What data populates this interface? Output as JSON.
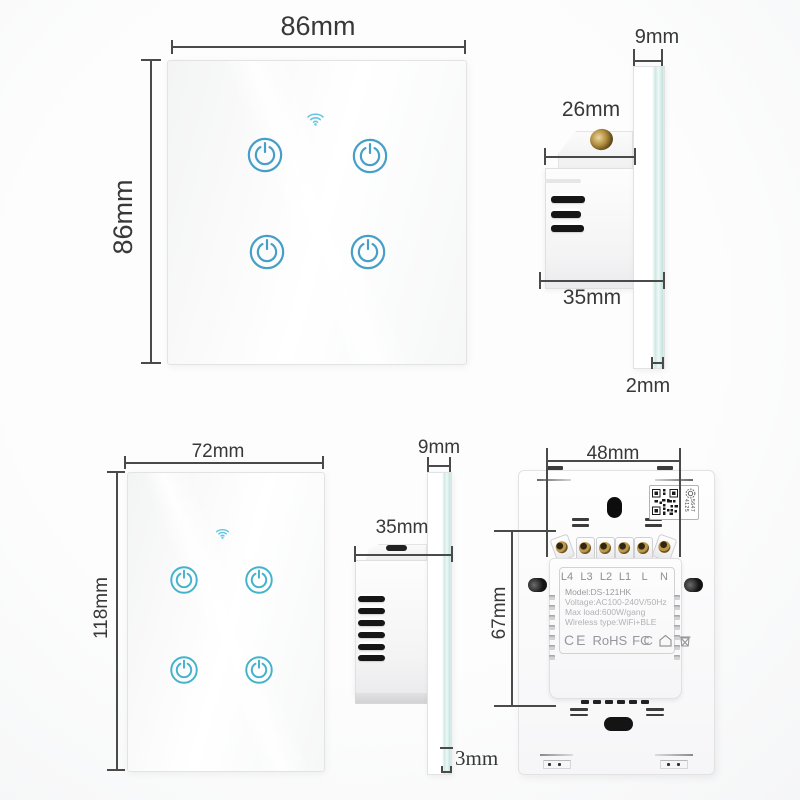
{
  "colors": {
    "accent_blue": "#459fc8",
    "accent_cyan": "#43b3cc",
    "wifi_blue": "#66c5e3",
    "glass_edge": "#cfe9e6",
    "dim_text": "#383838"
  },
  "front_eu": {
    "width_label": "86mm",
    "height_label": "86mm"
  },
  "side_eu": {
    "glass_width_label": "9mm",
    "box_depth_label": "26mm",
    "total_depth_label": "35mm",
    "glass_thickness_label": "2mm"
  },
  "front_us": {
    "width_label": "72mm",
    "height_label": "118mm"
  },
  "side_us": {
    "glass_width_label": "9mm",
    "depth_label": "35mm",
    "glass_thickness_label": "3mm"
  },
  "back": {
    "terminal_span_label": "48mm",
    "module_height_label": "67mm",
    "terminals": [
      "L4",
      "L3",
      "L2",
      "L1",
      "L",
      "N"
    ],
    "specs": [
      "Model:DS-121HK",
      "Voltage:AC100-240V/50Hz",
      "Max load:600W/gang",
      "Wireless type:WiFi+BLE"
    ],
    "certs": {
      "ce": "CE",
      "rohs": "RoHS",
      "fcc": "FC",
      "fcc2": "C"
    },
    "qr_side_text": "5647 4125"
  }
}
